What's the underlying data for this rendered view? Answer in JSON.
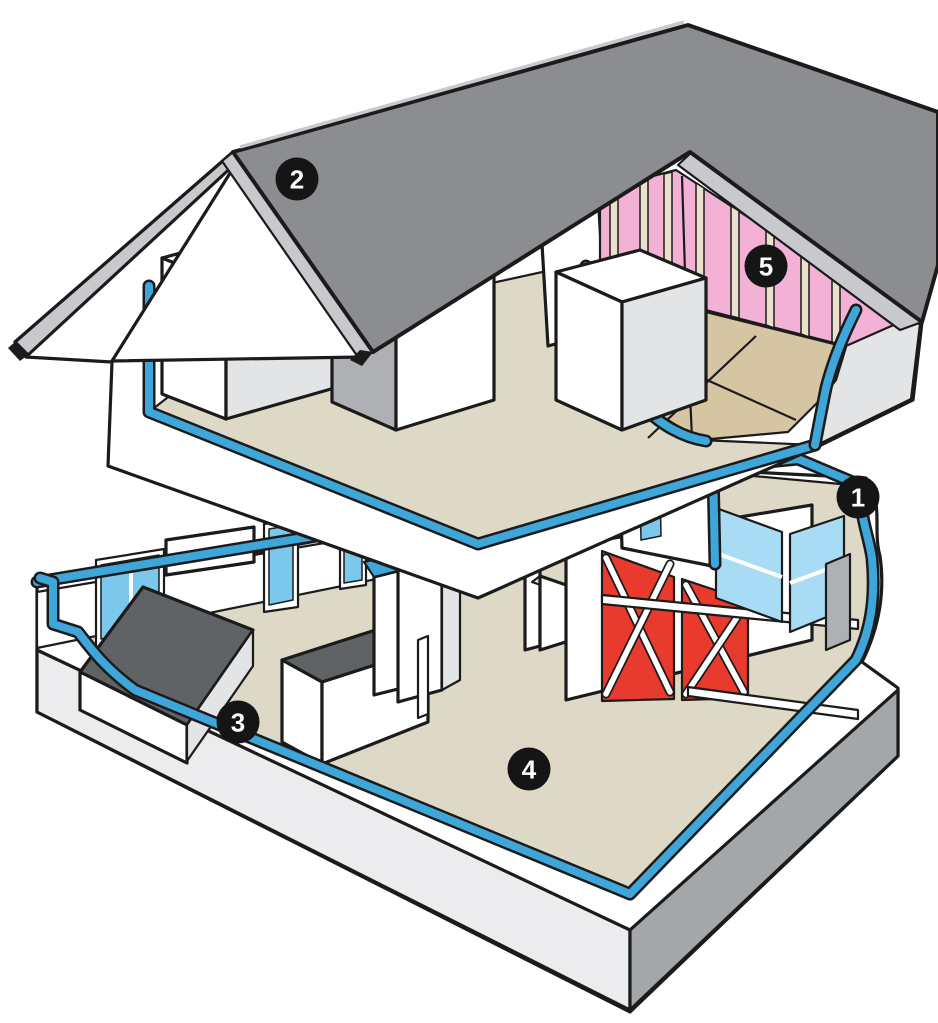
{
  "markers": {
    "m1": {
      "label": "1"
    },
    "m2": {
      "label": "2"
    },
    "m3": {
      "label": "3"
    },
    "m4": {
      "label": "4"
    },
    "m5": {
      "label": "5"
    }
  },
  "colors": {
    "outline": "#1b1b1b",
    "roof": "#8b8d90",
    "roof_dark": "#74767a",
    "fascia": "#c7c9cc",
    "white": "#ffffff",
    "shade": "#e2e4e6",
    "shade_dark": "#aeb0b3",
    "floor_tan": "#ded8c6",
    "osb": "#d5c5a3",
    "blue_membrane": "#3ea6d8",
    "window_glass": "#7cc8ec",
    "corner_glass": "#a8dcf4",
    "insulation_pink": "#f2b1d5",
    "stud_cream": "#e9e0cd",
    "shear_panel_red": "#e83a2d",
    "counter_gray": "#5f6366",
    "foundation_gray": "#a4a7aa",
    "foundation_light": "#ececee",
    "marker_bg": "#151515",
    "marker_fg": "#ffffff"
  }
}
